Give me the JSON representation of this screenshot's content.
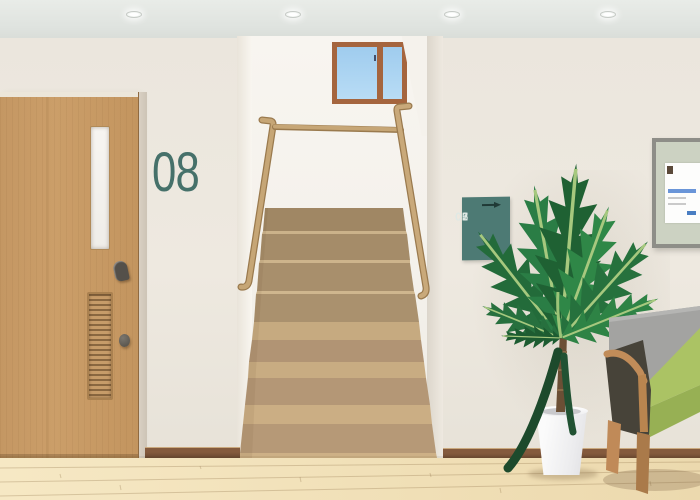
{
  "door": {
    "number": "08"
  },
  "sign": {
    "rows": [
      [
        "02",
        "01"
      ],
      [
        "05",
        "03"
      ],
      [
        "07",
        "06"
      ]
    ],
    "arrow_icon": "right-arrow",
    "bg_color": "#4d7a74",
    "text_color": "#dfe9e5"
  },
  "colors": {
    "accent_teal": "#4d7a74",
    "door_number_teal": "#46716a",
    "wall_cream": "#ece7de",
    "ceiling_gray": "#e2e6e2",
    "door_wood": "#c89b66",
    "stair_riser_dark": "#a58c69",
    "stair_tread_light": "#c8ac82",
    "handrail_wood": "#c2a273",
    "window_frame_brown": "#a5653e",
    "sky_blue": "#abd3f0",
    "seat_green": "#abc364",
    "backrest_gray": "#a3a3a1",
    "plant_green": "#2a7d45",
    "pot_white": "#f2f2f2",
    "floor_wood": "#f2e2bc",
    "baseboard_brown": "#6e4a33"
  }
}
